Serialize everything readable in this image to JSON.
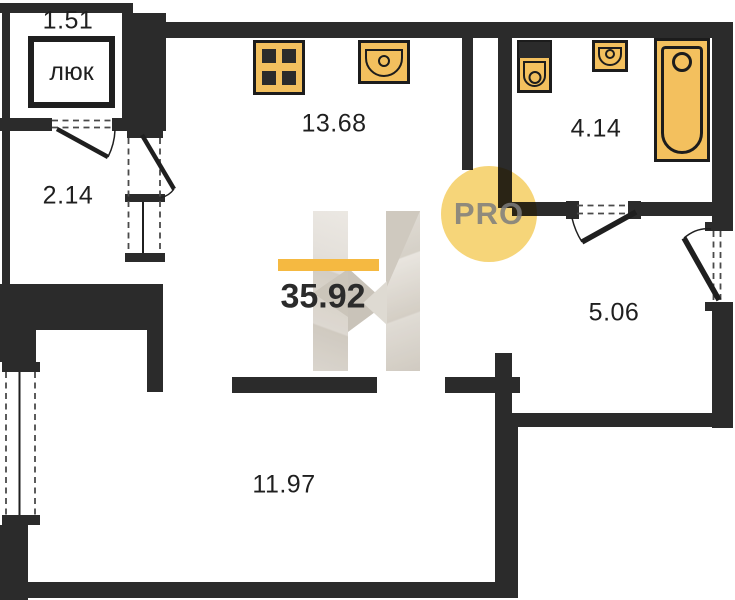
{
  "floorplan": {
    "total_area": "35.92",
    "watermark": {
      "pro": "PRO"
    },
    "rooms": {
      "hatch_closet": {
        "area": "1.51",
        "hatch_label": "люк"
      },
      "balcony": {
        "area": "2.14"
      },
      "kitchen_living": {
        "area": "13.68"
      },
      "bathroom": {
        "area": "4.14"
      },
      "hallway": {
        "area": "5.06"
      },
      "room": {
        "area": "11.97"
      }
    },
    "fixtures": {
      "stove": "stove-icon",
      "kitchen_sink": "kitchen-sink-icon",
      "toilet": "toilet-icon",
      "washbasin": "washbasin-icon",
      "bathtub": "bathtub-icon"
    },
    "colors": {
      "wall": "#2b2b2b",
      "fixture_fill": "#f3c05e",
      "accent_bar": "#f5b941",
      "pro_circle": "#f6d579",
      "watermark_beige": "#d9d3cb"
    }
  }
}
